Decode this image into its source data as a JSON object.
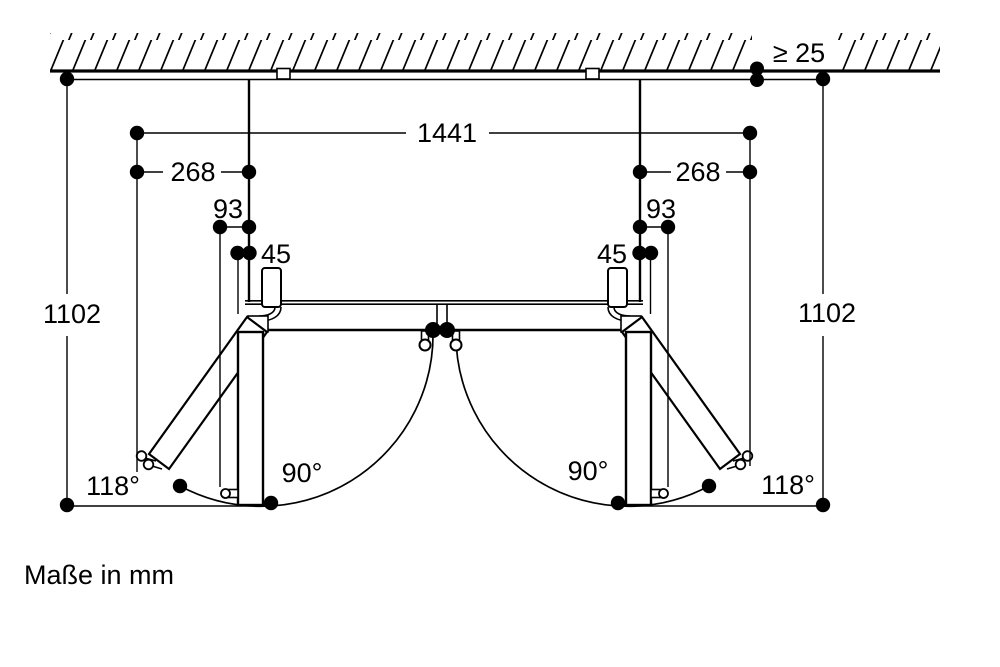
{
  "note": "Maße in mm",
  "dims": {
    "total_width": "1441",
    "side_left": "268",
    "side_right": "268",
    "handle_left": "93",
    "handle_right": "93",
    "door_left": "45",
    "door_right": "45",
    "depth_left": "1102",
    "depth_right": "1102",
    "wall_gap": "≥ 25"
  },
  "angles": {
    "open_90_left": "90°",
    "open_90_right": "90°",
    "open_118_left": "118°",
    "open_118_right": "118°"
  },
  "colors": {
    "line": "#000000",
    "background": "#ffffff"
  }
}
